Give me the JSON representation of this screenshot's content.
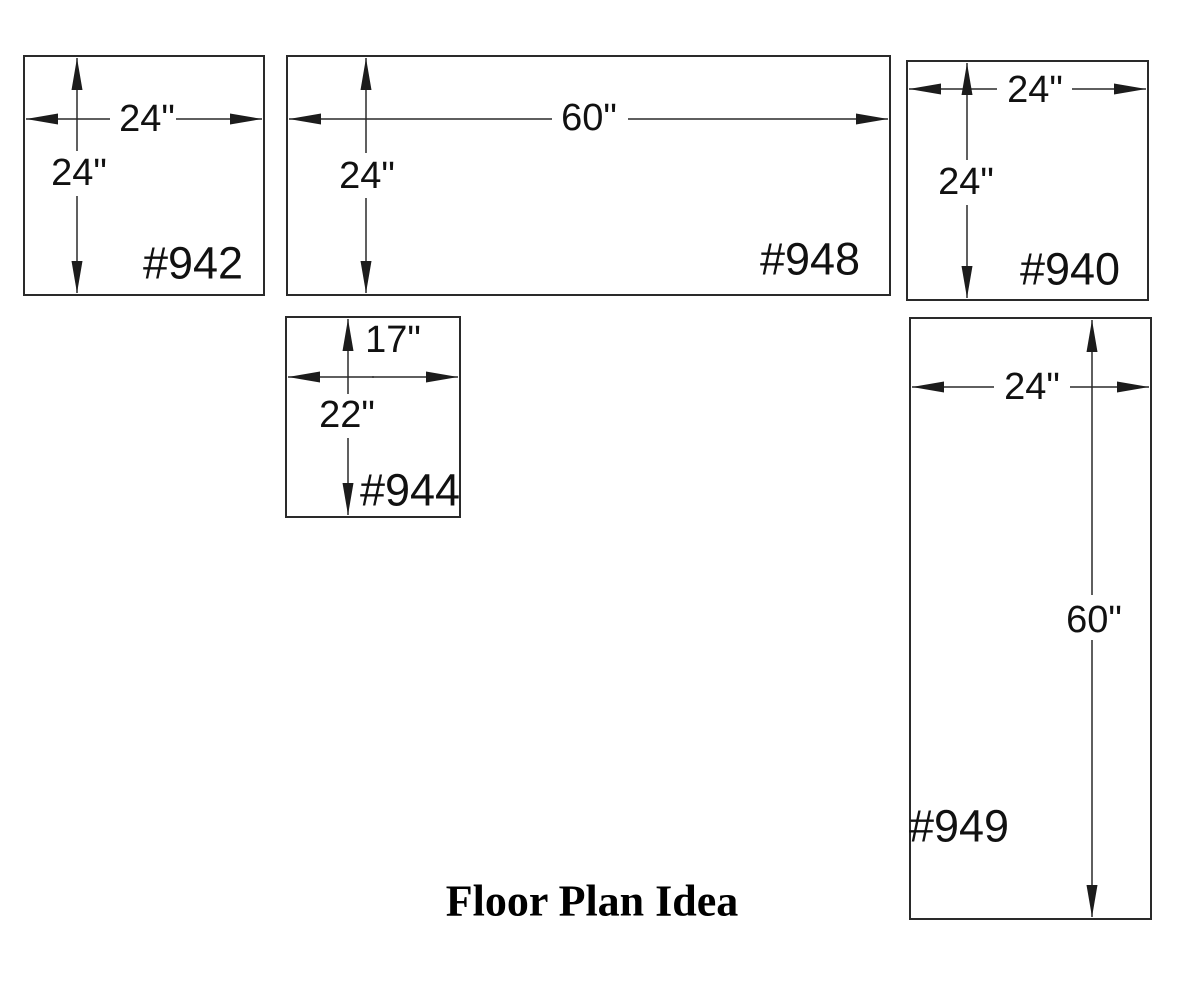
{
  "title": "Floor Plan Idea",
  "colors": {
    "ink": "#2a2a2a",
    "text": "#111111",
    "background": "#ffffff"
  },
  "cabinets": {
    "c942": {
      "label": "#942",
      "width": "24\"",
      "height": "24\""
    },
    "c948": {
      "label": "#948",
      "width": "60\"",
      "height": "24\""
    },
    "c940": {
      "label": "#940",
      "width": "24\"",
      "height": "24\""
    },
    "c944": {
      "label": "#944",
      "width": "17\"",
      "height": "22\""
    },
    "c949": {
      "label": "#949",
      "width": "24\"",
      "height": "60\""
    }
  }
}
